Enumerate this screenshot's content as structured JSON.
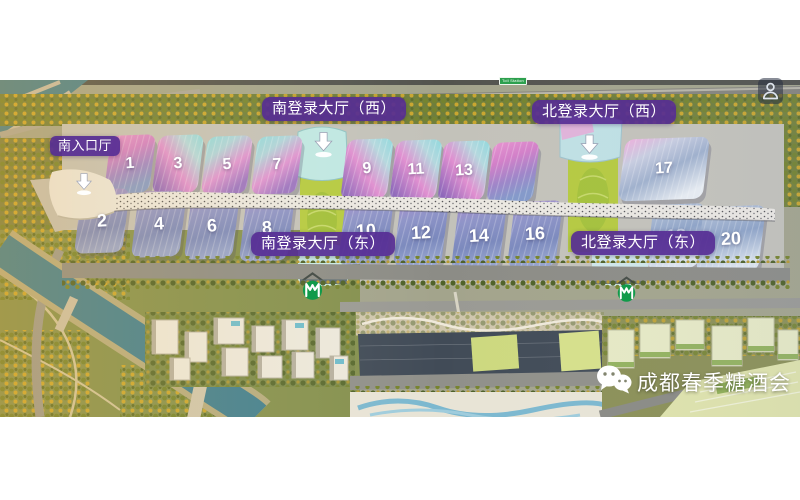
{
  "labels": {
    "south_entrance": "南入口厅",
    "south_login_west": "南登录大厅（西）",
    "south_login_east": "南登录大厅（东）",
    "north_login_west": "北登录大厅（西）",
    "north_login_east": "北登录大厅（东）"
  },
  "hall_numbers": [
    "1",
    "3",
    "5",
    "7",
    "9",
    "11",
    "13",
    "17",
    "2",
    "4",
    "6",
    "8",
    "10",
    "12",
    "14",
    "16",
    "18",
    "20"
  ],
  "toll_sign": {
    "text": "Toll Station"
  },
  "watermark": {
    "text": "成都春季糖酒会"
  },
  "icons": {
    "person": "person-outline in dark rounded square",
    "metro": "green circle with white metro M",
    "entrance_arrow": "white down arrow with base ellipse",
    "wechat": "white wechat double speech-bubble logo"
  },
  "colors": {
    "label_purple": "#562C94",
    "metro_green": "#119A4A",
    "toll_green": "#2DA04E",
    "hall_top_pink": "#DF8FD0",
    "hall_top_cyan": "#8FD9DD",
    "hall_bottom_blue": "#8B94C8",
    "river_teal": "#417F90",
    "canopy_white": "#EBE8E2"
  }
}
